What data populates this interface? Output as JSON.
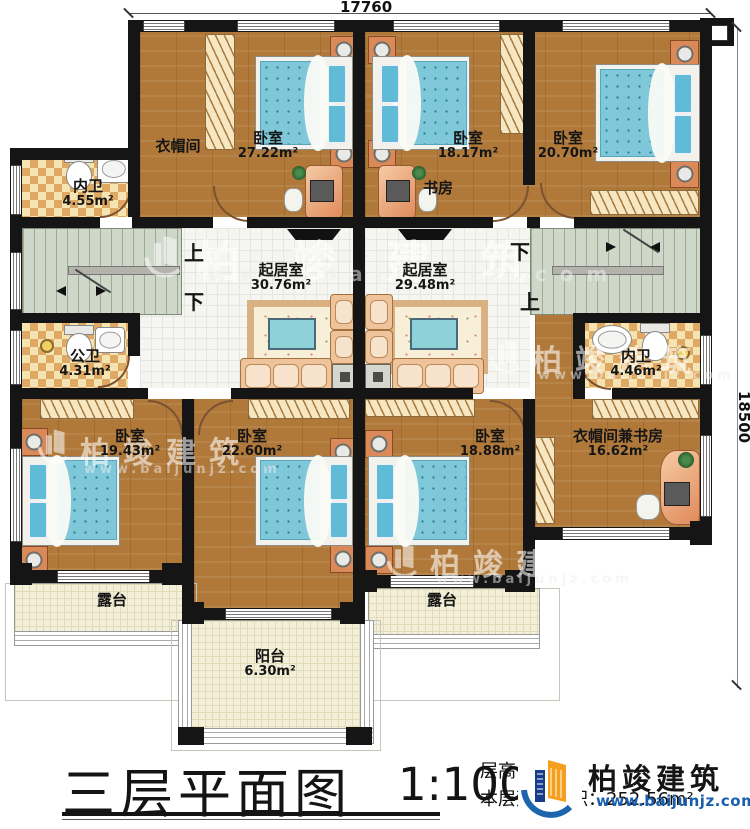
{
  "plan": {
    "dimensions": {
      "top": "17760",
      "right": "18500"
    },
    "stairs": {
      "up": "上",
      "down": "下"
    },
    "rooms": {
      "closet_tl": {
        "name": "衣帽间"
      },
      "bed_27": {
        "name": "卧室",
        "area": "27.22m²"
      },
      "bath_tl": {
        "name": "内卫",
        "area": "4.55m²"
      },
      "bed_1817": {
        "name": "卧室",
        "area": "18.17m²"
      },
      "study": {
        "name": "书房"
      },
      "bed_2070": {
        "name": "卧室",
        "area": "20.70m²"
      },
      "bath_pub": {
        "name": "公卫",
        "area": "4.31m²"
      },
      "living_l": {
        "name": "起居室",
        "area": "30.76m²"
      },
      "living_r": {
        "name": "起居室",
        "area": "29.48m²"
      },
      "bath_r": {
        "name": "内卫",
        "area": "4.46m²"
      },
      "bed_1943": {
        "name": "卧室",
        "area": "19.43m²"
      },
      "bed_2260": {
        "name": "卧室",
        "area": "22.60m²"
      },
      "bed_1888": {
        "name": "卧室",
        "area": "18.88m²"
      },
      "closet_study": {
        "name": "衣帽间兼书房",
        "area": "16.62m²"
      },
      "terrace_l": {
        "name": "露台"
      },
      "terrace_r": {
        "name": "露台"
      },
      "balcony": {
        "name": "阳台",
        "area": "6.30m²"
      }
    }
  },
  "title_block": {
    "title": "三层平面图",
    "scale": "1:100",
    "floor_height": "层高：3.5m",
    "floor_area": "本层建筑面积：252.56m²"
  },
  "logo": {
    "name": "柏竣建筑",
    "url": "www.baijunjz.com"
  },
  "watermark": {
    "name": "柏竣建筑",
    "url": "www.baijunjz.com"
  },
  "colors": {
    "wall": "#151515",
    "wood_floor": "#b0793a",
    "bed_blue": "#7ec8da",
    "stair_green": "#ced7c8",
    "checker_tan": "#dfa963",
    "logo_orange": "#f59f1e",
    "logo_blue": "#1d66ad"
  }
}
